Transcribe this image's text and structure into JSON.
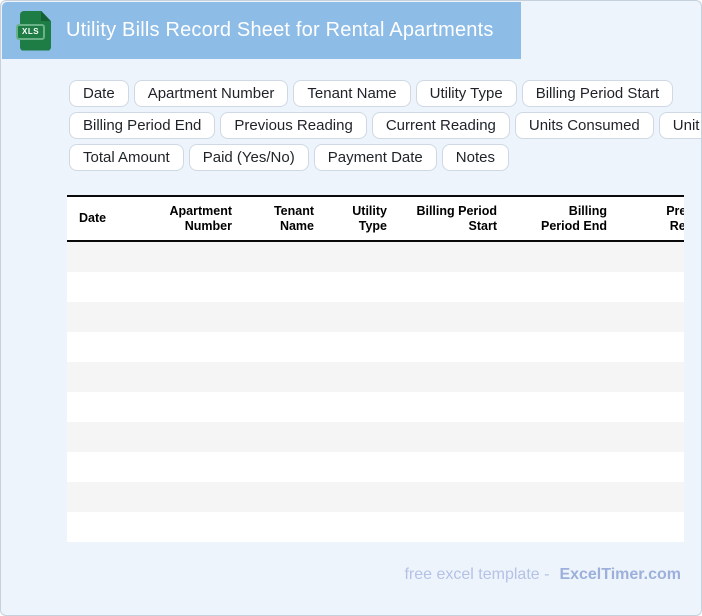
{
  "header": {
    "title": "Utility Bills Record Sheet for Rental Apartments",
    "file_type_label": "XLS"
  },
  "chips": {
    "rows": [
      [
        "Date",
        "Apartment Number",
        "Tenant Name",
        "Utility Type",
        "Billing Period Start"
      ],
      [
        "Billing Period End",
        "Previous Reading",
        "Current Reading",
        "Units Consumed",
        "Unit Rate"
      ],
      [
        "Total Amount",
        "Paid (Yes/No)",
        "Payment Date",
        "Notes"
      ]
    ]
  },
  "table": {
    "columns": [
      {
        "label": "Date",
        "lines": [
          "Date"
        ],
        "align": "left"
      },
      {
        "label": "Apartment Number",
        "lines": [
          "Apartment",
          "Number"
        ],
        "align": "right"
      },
      {
        "label": "Tenant Name",
        "lines": [
          "Tenant",
          "Name"
        ],
        "align": "right"
      },
      {
        "label": "Utility Type",
        "lines": [
          "Utility",
          "Type"
        ],
        "align": "right"
      },
      {
        "label": "Billing Period Start",
        "lines": [
          "Billing Period",
          "Start"
        ],
        "align": "right"
      },
      {
        "label": "Billing Period End",
        "lines": [
          "Billing",
          "Period End"
        ],
        "align": "right"
      },
      {
        "label": "Previous Reading",
        "lines": [
          "Previous",
          "Reading"
        ],
        "align": "right"
      }
    ],
    "empty_row_count": 10
  },
  "footer": {
    "caption": "free excel template -",
    "brand": "ExcelTimer.com"
  },
  "colors": {
    "banner_blue": "#8dbce7",
    "page_bg": "#edf4fb",
    "card_border": "#c6d1dc",
    "chip_border": "#d0d9e3",
    "chip_text": "#1f2328",
    "stripe_gray": "#f5f5f6",
    "header_border": "#0a0a0a",
    "icon_green": "#1e7c45",
    "icon_fold_green": "#146136",
    "footer_text": "#b5c2e6",
    "brand_text": "#9db0dc"
  }
}
